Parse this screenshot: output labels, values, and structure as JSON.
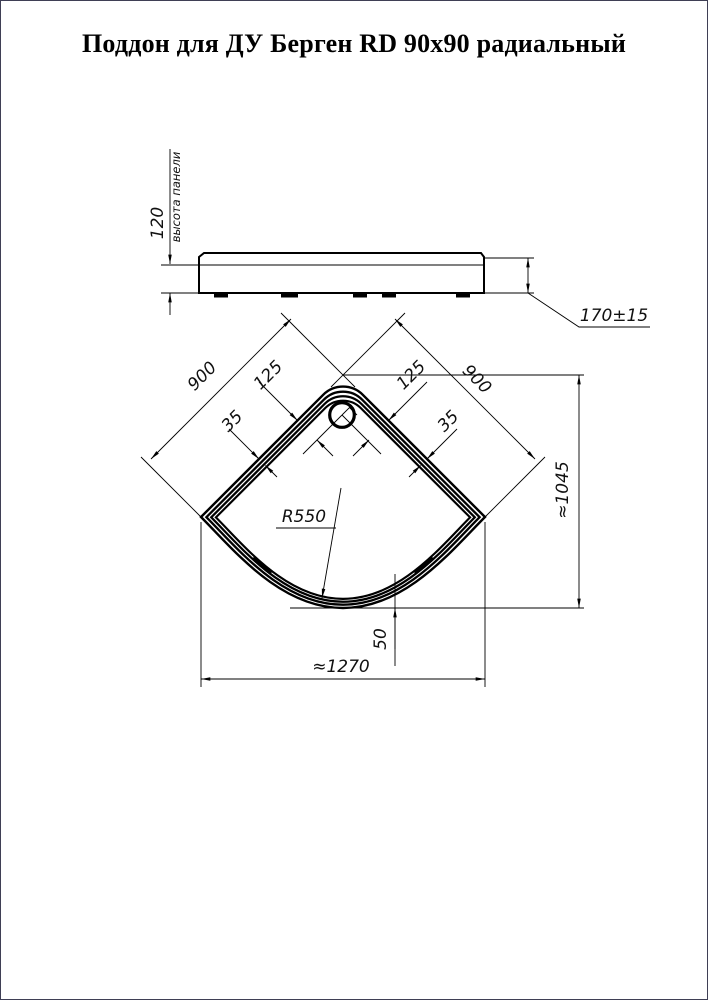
{
  "title": "Поддон для ДУ Берген RD 90x90 радиальный",
  "side_view": {
    "panel_height_value": "120",
    "panel_height_label": "высота панели",
    "overall_height": "170±15"
  },
  "plan_view": {
    "side_left": "900",
    "side_right": "900",
    "drain_offset_left": "125",
    "drain_offset_right": "125",
    "rim_width_left": "35",
    "rim_width_right": "35",
    "front_radius": "R550",
    "overall_depth": "≈1045",
    "overall_width": "≈1270",
    "front_offset": "50"
  }
}
